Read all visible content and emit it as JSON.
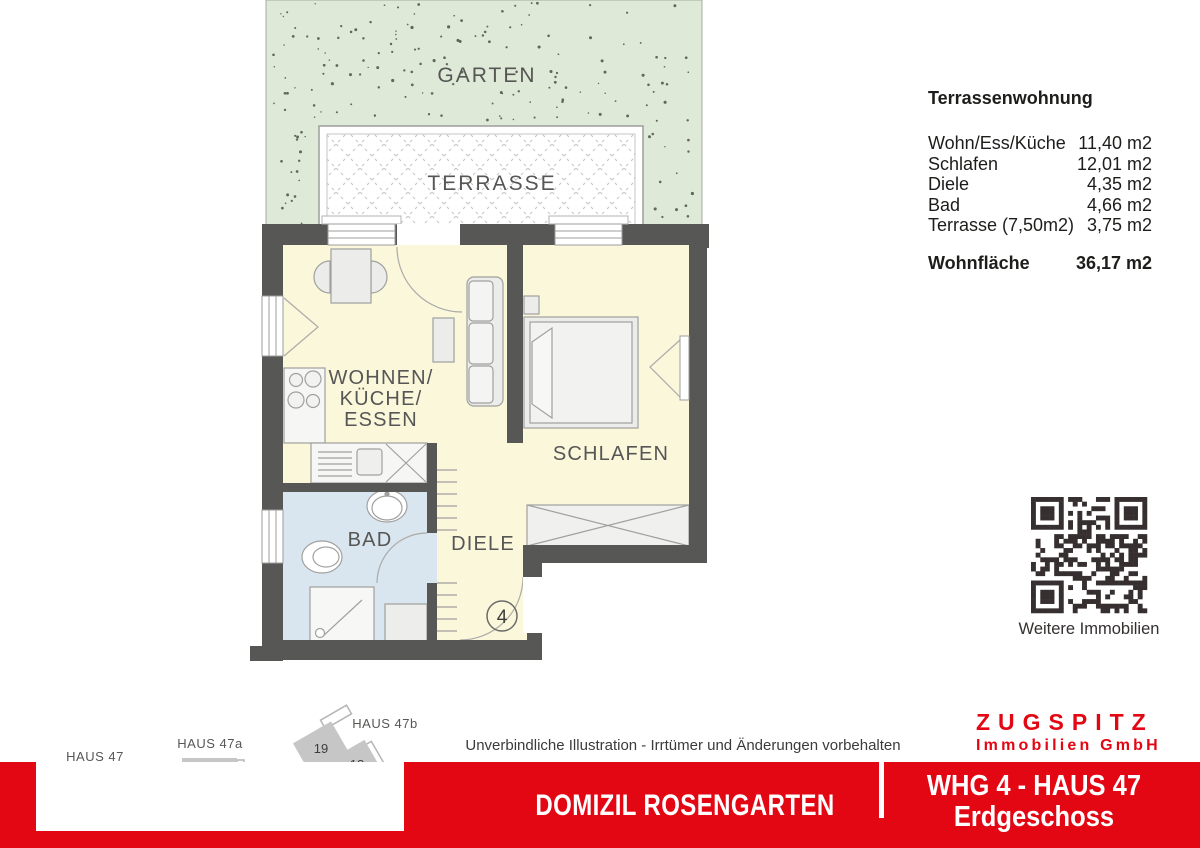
{
  "colors": {
    "accent": "#e30613",
    "wall": "#575756",
    "room": "#faf7db",
    "bath": "#d9e5ef",
    "garden": "#dfe9d8",
    "qr": "#362f30"
  },
  "floorplan": {
    "labels": {
      "garten": "GARTEN",
      "terrasse": "TERRASSE",
      "wohnen_line1": "WOHNEN/",
      "wohnen_line2": "KÜCHE/",
      "wohnen_line3": "ESSEN",
      "schlafen": "SCHLAFEN",
      "bad": "BAD",
      "diele": "DIELE"
    },
    "unit_number": "4"
  },
  "area_table": {
    "title": "Terrassenwohnung",
    "rows": [
      {
        "label": "Wohn/Ess/Küche",
        "value": "11,40 m2"
      },
      {
        "label": "Schlafen",
        "value": "12,01 m2"
      },
      {
        "label": "Diele",
        "value": "4,35 m2"
      },
      {
        "label": "Bad",
        "value": "4,66 m2"
      },
      {
        "label": "Terrasse (7,50m2)",
        "value": "3,75 m2"
      }
    ],
    "total": {
      "label": "Wohnfläche",
      "value": "36,17 m2"
    }
  },
  "qr": {
    "caption": "Weitere Immobilien"
  },
  "siteplan": {
    "haus47": {
      "label": "HAUS 47",
      "units": [
        "1",
        "4",
        "2",
        "3"
      ],
      "highlighted_unit": "4"
    },
    "haus47a": {
      "label": "HAUS 47a",
      "units": [
        "12",
        "11"
      ]
    },
    "haus47b": {
      "label": "HAUS 47b",
      "units": [
        "19",
        "18",
        "17"
      ]
    },
    "north_label": "N"
  },
  "footer": {
    "disclaimer": "Unverbindliche Illustration - Irrtümer und Änderungen vorbehalten",
    "project": "DOMIZIL ROSENGARTEN",
    "unit_title": "WHG 4 - HAUS 47",
    "floor": "Erdgeschoss",
    "brand_name": "ZUGSPITZ",
    "brand_subtitle": "Immobilien GmbH"
  }
}
